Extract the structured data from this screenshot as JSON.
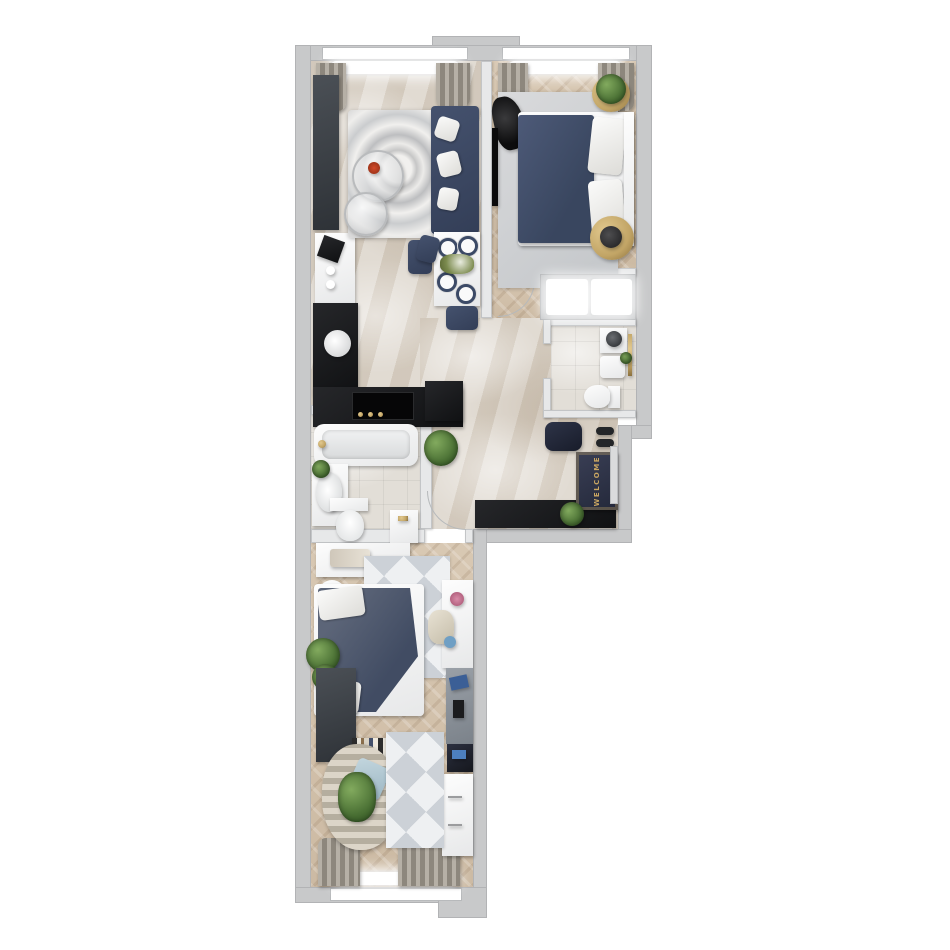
{
  "meta": {
    "kind": "apartment-floor-plan-3d-render",
    "view": "top-down",
    "units_shown": "none"
  },
  "entrance": {
    "doormat_text": "WELCOME"
  },
  "palette": {
    "wall": "#c8c9ca",
    "wallEdge": "#b2b3b5",
    "partition": "#e7e8e9",
    "marble": "#d9d1c6",
    "wood": "#d8c8b3",
    "woodDark": "#ccbaa3",
    "navy": "#45526e",
    "navyDeep": "#333e57",
    "counterBlack": "#17181a",
    "gold": "#c2a566",
    "green": "#4a7034",
    "rugLight": "#d9dadc",
    "white": "#f6f6f6"
  },
  "rooms": [
    {
      "id": "living-kitchen",
      "floor": "marble-tile",
      "items": [
        "tall-wardrobe-unit",
        "appliance-counter",
        "coffee-machine",
        "l-shaped-kitchen-counter",
        "kitchen-sink",
        "cooktop",
        "corner-sofa",
        "sofa-pillows",
        "glass-coffee-tables",
        "swirl-area-rug",
        "dining-table",
        "dining-chairs",
        "place-settings",
        "window",
        "curtains"
      ]
    },
    {
      "id": "bedroom-1",
      "floor": "herringbone-wood",
      "items": [
        "double-bed-navy",
        "pillows",
        "headboard",
        "gold-side-table-with-plant",
        "gold-side-table",
        "black-chair",
        "wall-tv",
        "area-rug",
        "window",
        "curtains"
      ]
    },
    {
      "id": "closet",
      "items": [
        "sliding-door-wardrobe-lit"
      ]
    },
    {
      "id": "bathroom-2",
      "floor": "tile",
      "items": [
        "washing-machine",
        "sink",
        "toilet",
        "towel-rail"
      ]
    },
    {
      "id": "hallway",
      "floor": "marble-tile",
      "items": [
        "entry-bench",
        "shoes",
        "welcome-doormat",
        "black-console",
        "plant",
        "entry-door"
      ]
    },
    {
      "id": "bathroom-1",
      "floor": "tile",
      "items": [
        "bathtub",
        "sink-with-plant",
        "toilet",
        "cabinet"
      ]
    },
    {
      "id": "bedroom-2",
      "floor": "herringbone-wood",
      "items": [
        "white-dresser",
        "round-stool",
        "single-bed",
        "pillows",
        "plants",
        "triangle-rug",
        "desk",
        "desk-chair",
        "gray-shelf-unit",
        "dark-wardrobe",
        "book-shelf",
        "striped-pouf",
        "blue-pillow",
        "white-cabinet",
        "triangle-rug-2",
        "window",
        "curtains"
      ]
    }
  ]
}
